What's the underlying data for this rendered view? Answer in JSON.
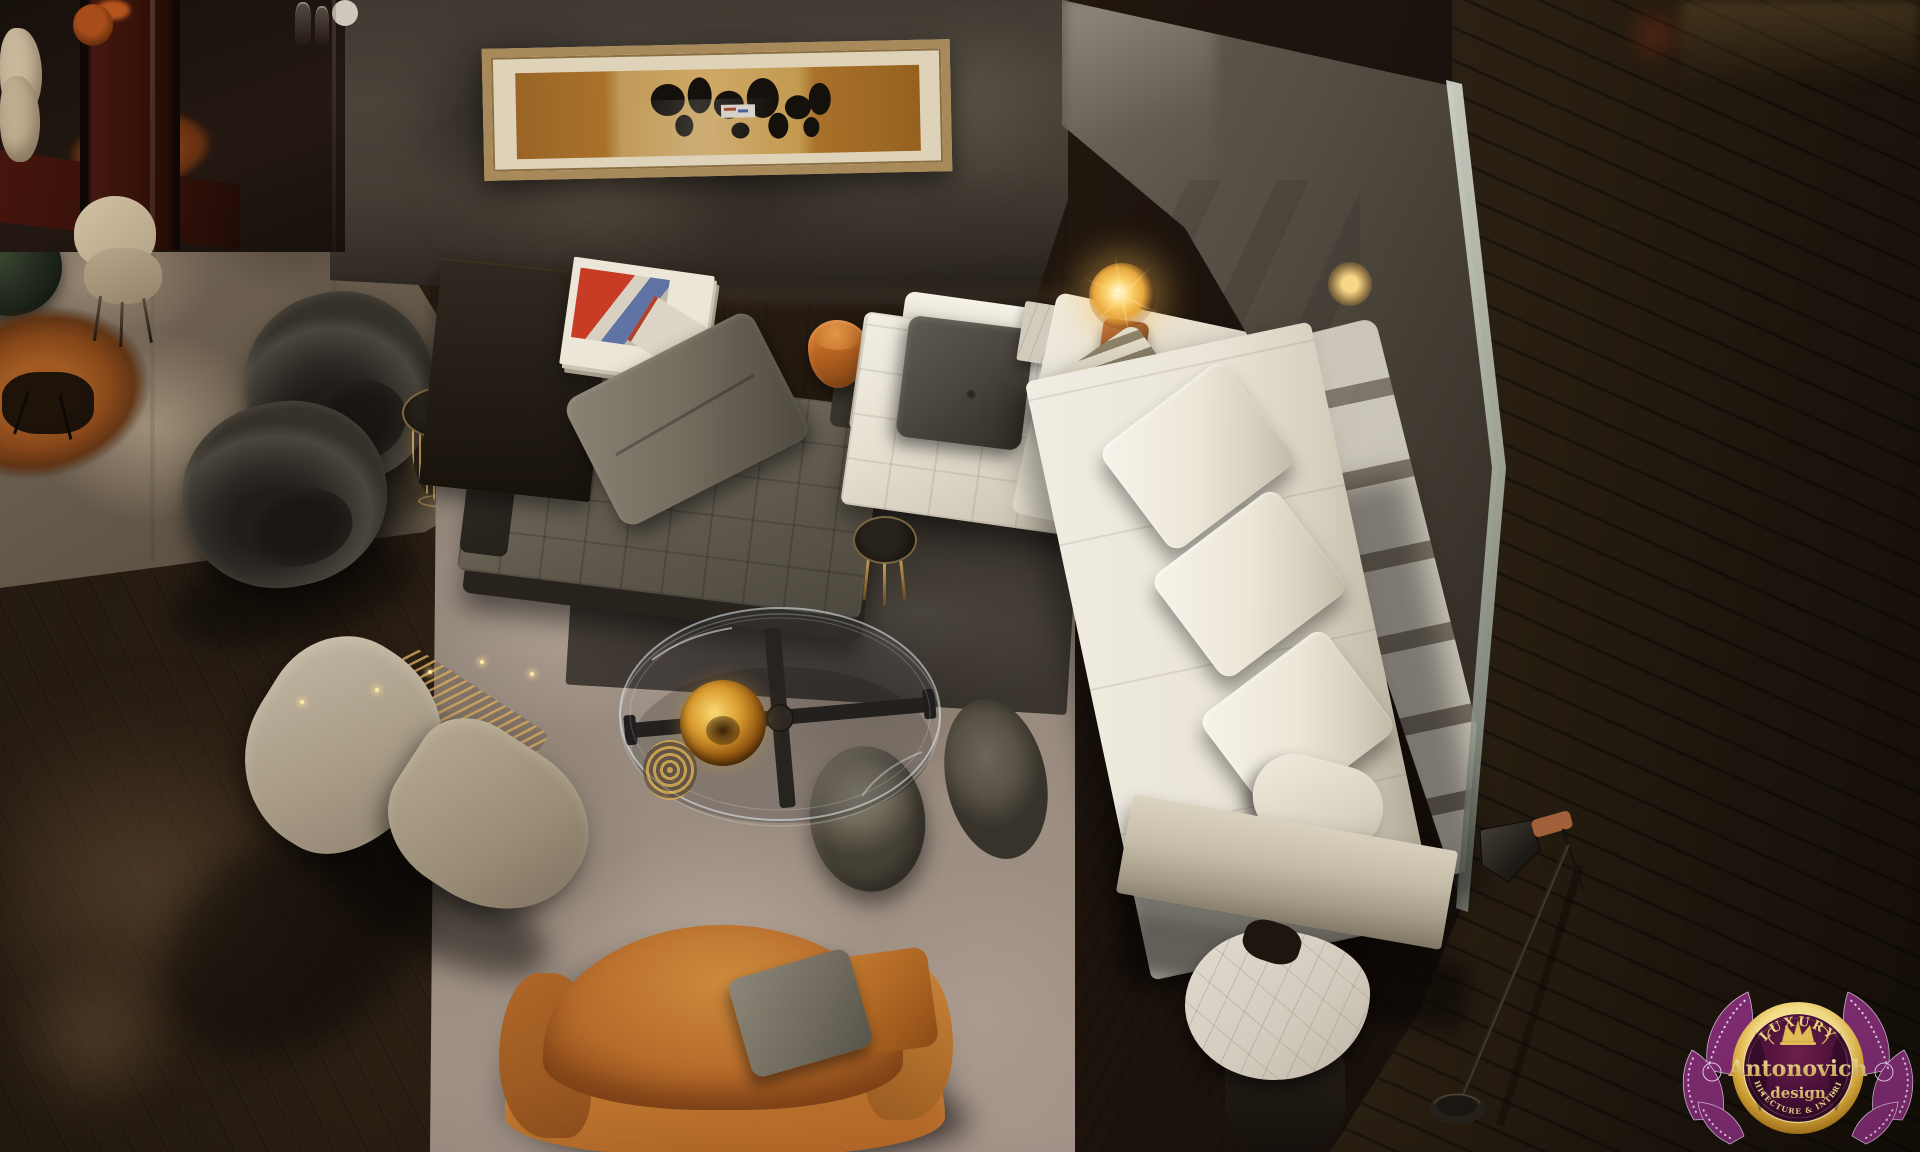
{
  "scene": {
    "type": "interior-photograph",
    "setting": "Aerial view of a luxury furniture showroom living area with sectional sofas, lounge chairs and designer tables"
  },
  "watermark": {
    "luxury": "LUXURY",
    "brand": "Antonovich",
    "design_label": "· design ·",
    "tagline": "ARCHITECTURE & INTERIORS"
  },
  "palette": {
    "floor_dark": "#1d140d",
    "wall_gray": "#453e35",
    "mirror_gray": "#554e44",
    "rug_left_taupe": "#6b5e4f",
    "rug_center_gray": "#968a7e",
    "sofa_white": "#eae5d8",
    "daybed_gray": "#6e675a",
    "accent_orange": "#c06722",
    "accent_gold": "#d8ac60",
    "lamp_glow": "#fbd06a",
    "logo_purple": "#7e2c70",
    "logo_gold": "#e8c25a"
  }
}
